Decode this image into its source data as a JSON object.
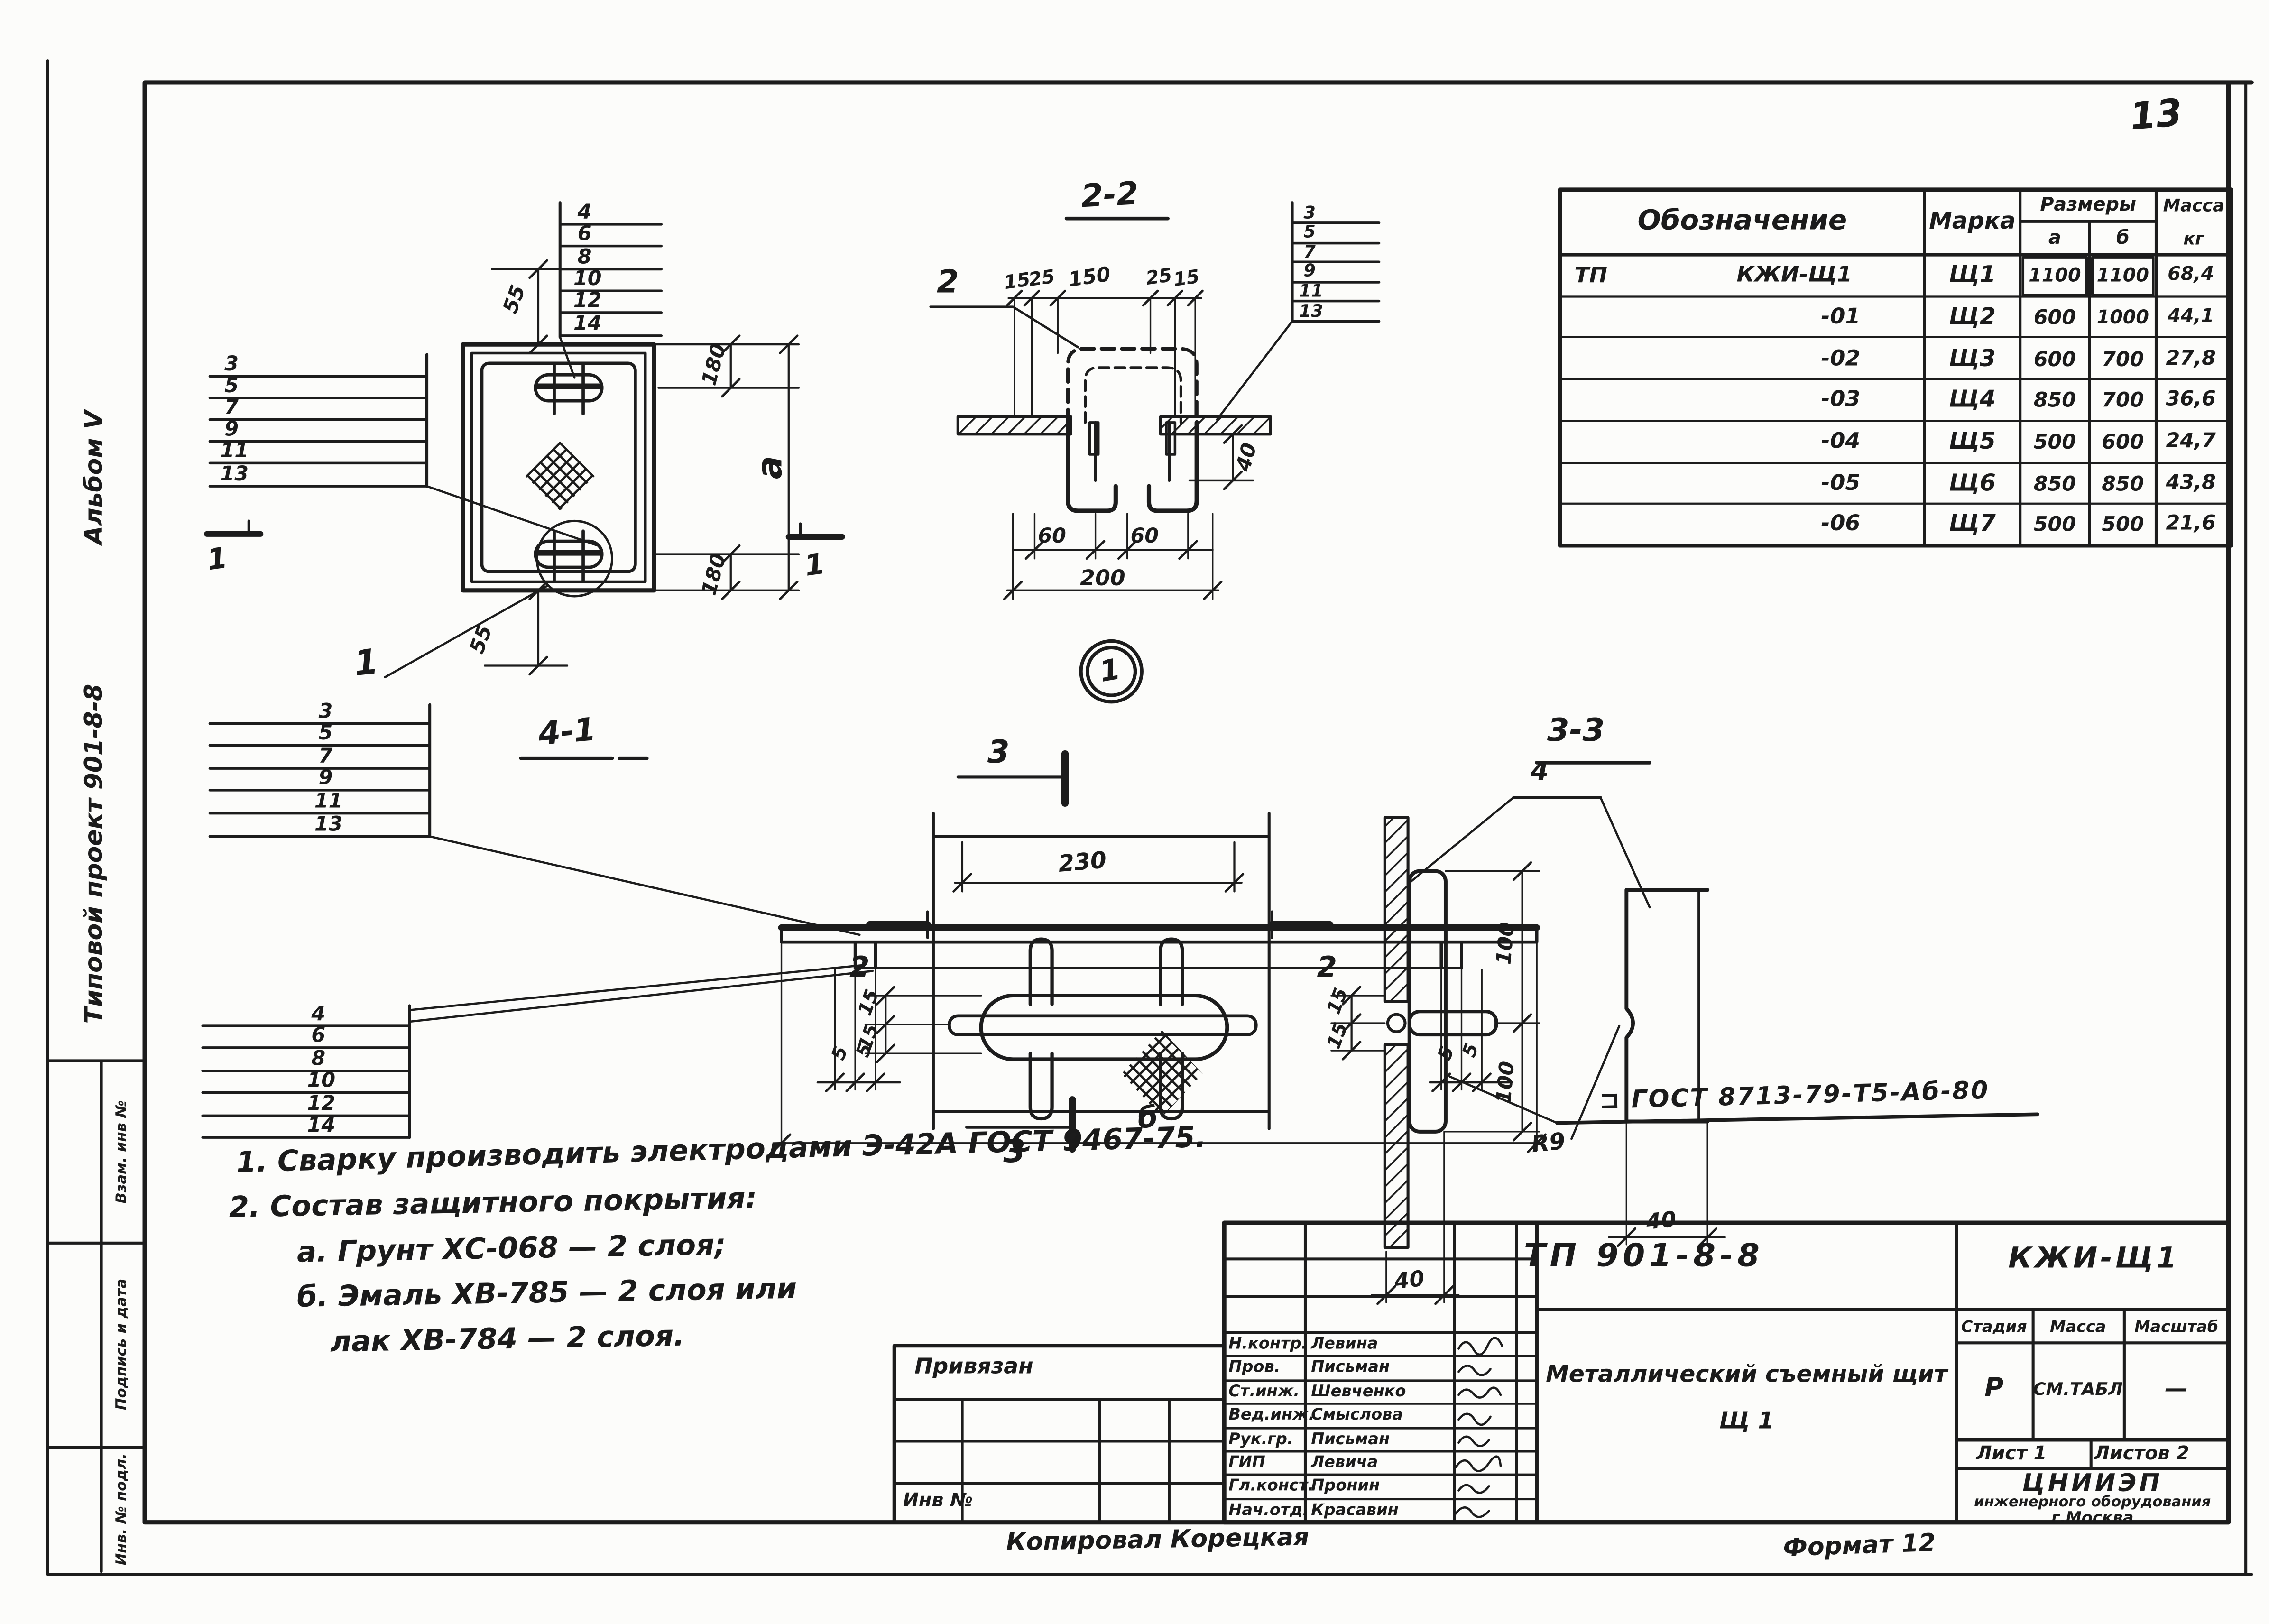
{
  "page": {
    "number": "13"
  },
  "sidebar": {
    "album": "Альбом V",
    "project": "Типовой проект 901-8-8",
    "stamps": [
      "Взам. инв №",
      "Подпись и дата",
      "Инв. № подл."
    ]
  },
  "parts_table": {
    "headers": {
      "designation": "Обозначение",
      "mark": "Марка",
      "sizes": "Размеры",
      "size_a": "а",
      "size_b": "б",
      "mass": "Масса",
      "mass_unit": "кг"
    },
    "rows": [
      {
        "prefix": "ТП",
        "designation": "КЖИ-Щ1",
        "mark": "Щ1",
        "a": "1100",
        "b": "1100",
        "mass": "68,4"
      },
      {
        "prefix": "",
        "designation": "-01",
        "mark": "Щ2",
        "a": "600",
        "b": "1000",
        "mass": "44,1"
      },
      {
        "prefix": "",
        "designation": "-02",
        "mark": "Щ3",
        "a": "600",
        "b": "700",
        "mass": "27,8"
      },
      {
        "prefix": "",
        "designation": "-03",
        "mark": "Щ4",
        "a": "850",
        "b": "700",
        "mass": "36,6"
      },
      {
        "prefix": "",
        "designation": "-04",
        "mark": "Щ5",
        "a": "500",
        "b": "600",
        "mass": "24,7"
      },
      {
        "prefix": "",
        "designation": "-05",
        "mark": "Щ6",
        "a": "850",
        "b": "850",
        "mass": "43,8"
      },
      {
        "prefix": "",
        "designation": "-06",
        "mark": "Щ7",
        "a": "500",
        "b": "500",
        "mass": "21,6"
      }
    ]
  },
  "plan_view": {
    "ladder_top": [
      "4",
      "6",
      "8",
      "10",
      "12",
      "14"
    ],
    "ladder_left": [
      "3",
      "5",
      "7",
      "9",
      "11",
      "13"
    ],
    "dims": {
      "d55_top": "55",
      "d55_bottom": "55",
      "d180_top": "180",
      "d180_bottom": "180",
      "width_a": "а"
    },
    "section_mark_left": "1",
    "section_mark_right": "1",
    "detail_label": "1"
  },
  "section_2_2": {
    "title": "2-2",
    "leader": "2",
    "top_dims": [
      "15",
      "25",
      "150",
      "25",
      "15"
    ],
    "ladder": [
      "3",
      "5",
      "7",
      "9",
      "11",
      "13"
    ],
    "d40": "40",
    "d60_left": "60",
    "d60_right": "60",
    "d200": "200"
  },
  "detail_bubble": {
    "label": "1"
  },
  "section_4_1": {
    "title": "4-1",
    "ladder_top": [
      "3",
      "5",
      "7",
      "9",
      "11",
      "13"
    ],
    "ladder_bottom": [
      "4",
      "6",
      "8",
      "10",
      "12",
      "14"
    ],
    "d5": [
      "5",
      "5",
      "5",
      "5"
    ],
    "width_b": "б"
  },
  "handle_plan": {
    "mark_top": "3",
    "mark_bottom": "3",
    "mark_left": "2",
    "mark_right": "2",
    "d230": "230",
    "d15": [
      "15",
      "15"
    ]
  },
  "section_3_3": {
    "title": "3-3",
    "leader": "4",
    "d15": [
      "15",
      "15"
    ],
    "d100": [
      "100",
      "100"
    ],
    "r9": "R9",
    "d40_left": "40",
    "d40_right": "40",
    "weld_note": "⊐ ГОСТ 8713-79-Т5-Аб-80"
  },
  "notes": {
    "lines": [
      "1. Сварку производить электродами Э-42А ГОСТ 9467-75.",
      "2. Состав защитного покрытия:",
      "а. Грунт ХС-068 — 2 слоя;",
      "б. Эмаль ХВ-785 — 2 слоя или",
      "лак ХВ-784  —  2 слоя."
    ]
  },
  "title_block": {
    "doc_code": "ТП 901-8-8",
    "item_code": "КЖИ-Щ1",
    "title_line1": "Металлический съемный щит",
    "title_line2": "Щ 1",
    "stage_label": "Стадия",
    "mass_label": "Масса",
    "scale_label": "Масштаб",
    "stage_value": "Р",
    "mass_value": "СМ.ТАБЛ",
    "scale_value": "—",
    "sheet_info": "Лист 1",
    "sheets_info": "Листов 2",
    "org_line1": "ЦНИИЭП",
    "org_line2": "инженерного оборудования",
    "org_line3": "г.Москва",
    "signers": [
      {
        "role": "Н.контр.",
        "name": "Левина"
      },
      {
        "role": "Пров.",
        "name": "Письман"
      },
      {
        "role": "Ст.инж.",
        "name": "Шевченко"
      },
      {
        "role": "Вед.инж.",
        "name": "Смыслова"
      },
      {
        "role": "Рук.гр.",
        "name": "Письман"
      },
      {
        "role": "ГИП",
        "name": "Левича"
      },
      {
        "role": "Гл.конст.",
        "name": "Пронин"
      },
      {
        "role": "Нач.отд.",
        "name": "Красавин"
      }
    ],
    "attach_label": "Привязан",
    "inv_label": "Инв №",
    "copy_note": "Копировал Корецкая",
    "format_note": "Формат 12"
  }
}
